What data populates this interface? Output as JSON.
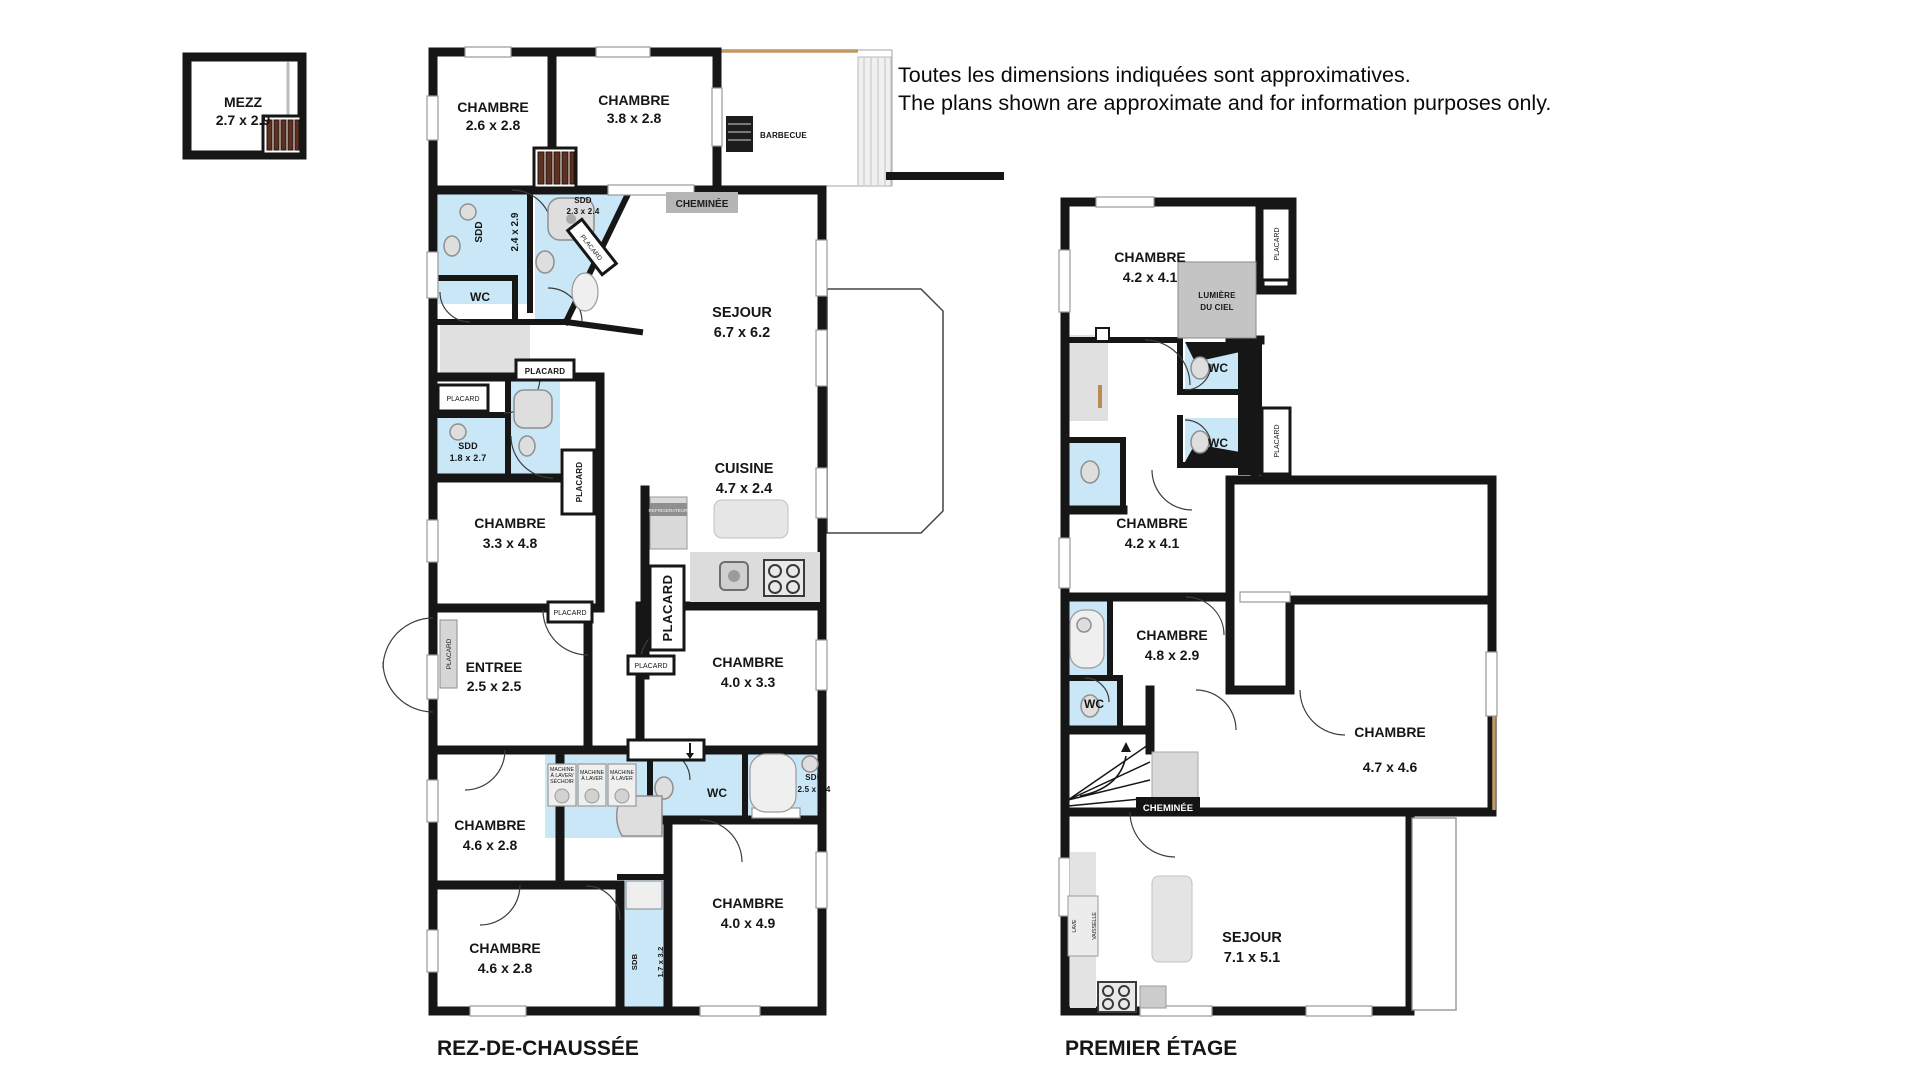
{
  "disclaimer": {
    "fr": "Toutes les dimensions indiquées sont approximatives.",
    "en": "The plans shown are approximate and for information purposes only."
  },
  "mezzanine": {
    "label": "MEZZ",
    "dims": "2.7 x 2.9"
  },
  "labels": {
    "wc": "WC",
    "placard": "PLACARD",
    "cheminee": "CHEMINÉE",
    "barbecue": "BARBECUE",
    "refrigerateur": "REFRIGERATEUR",
    "machine_l1": "MACHINE",
    "machine_l2": "À LAVER/",
    "machine_l3": "SÉCHOIR",
    "machine_b2": "À LAVER",
    "lave_1": "LAVE",
    "lave_2": "VAISSELLE",
    "lumiere_1": "LUMIÈRE",
    "lumiere_2": "DU CIEL"
  },
  "ground_floor": {
    "title": "REZ-DE-CHAUSSÉE",
    "rooms": [
      {
        "name": "CHAMBRE",
        "dims": "2.6 x 2.8"
      },
      {
        "name": "CHAMBRE",
        "dims": "3.8 x 2.8"
      },
      {
        "name": "SDD",
        "dims": "2.4 x 2.9"
      },
      {
        "name": "SDD",
        "dims": "2.3 x 2.4"
      },
      {
        "name": "SEJOUR",
        "dims": "6.7 x 6.2"
      },
      {
        "name": "SDD",
        "dims": "1.8 x 2.7"
      },
      {
        "name": "CHAMBRE",
        "dims": "3.3 x 4.8"
      },
      {
        "name": "CUISINE",
        "dims": "4.7 x 2.4"
      },
      {
        "name": "ENTREE",
        "dims": "2.5 x 2.5"
      },
      {
        "name": "CHAMBRE",
        "dims": "4.0 x 3.3"
      },
      {
        "name": "SDB",
        "dims": "2.5 x 1.4"
      },
      {
        "name": "CHAMBRE",
        "dims": "4.6 x 2.8"
      },
      {
        "name": "CHAMBRE",
        "dims": "4.6 x 2.8"
      },
      {
        "name": "CHAMBRE",
        "dims": "4.0 x 4.9"
      },
      {
        "name": "SDB",
        "dims": "1.7 x 3.2"
      }
    ]
  },
  "first_floor": {
    "title": "PREMIER ÉTAGE",
    "rooms": [
      {
        "name": "CHAMBRE",
        "dims": "4.2 x 4.1"
      },
      {
        "name": "CHAMBRE",
        "dims": "4.2 x 4.1"
      },
      {
        "name": "CHAMBRE",
        "dims": "4.8 x 2.9"
      },
      {
        "name": "CHAMBRE",
        "dims": "4.7 x 4.6"
      },
      {
        "name": "SEJOUR",
        "dims": "7.1 x 5.1"
      }
    ]
  }
}
